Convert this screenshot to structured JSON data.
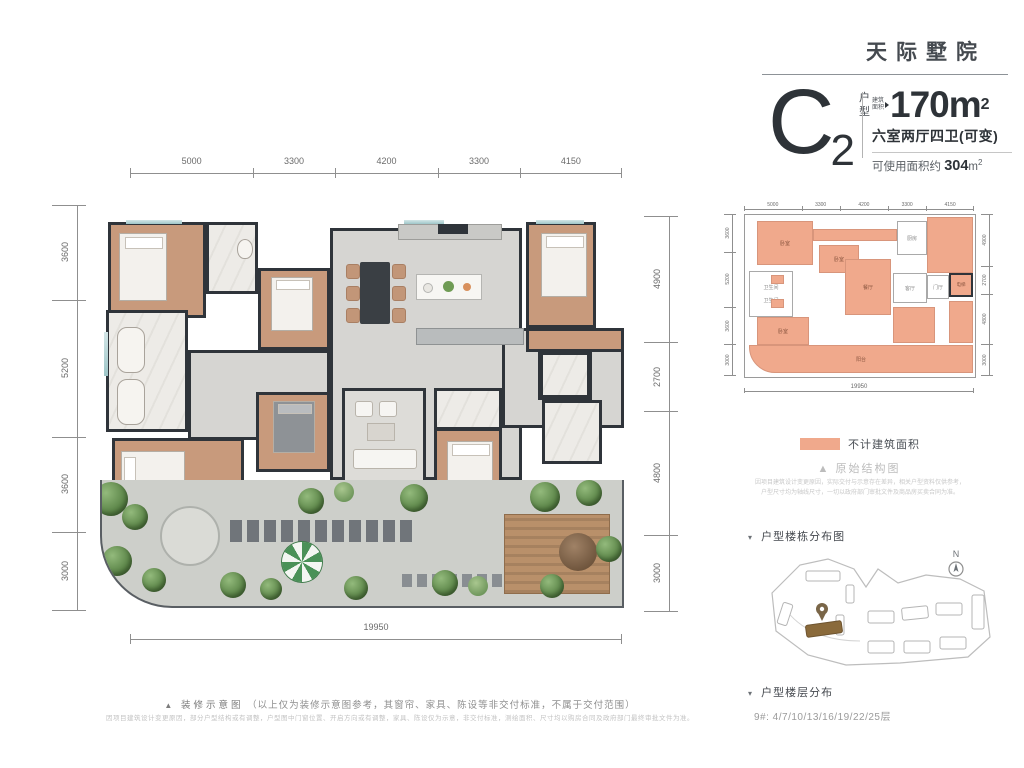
{
  "brand": {
    "title": "天际墅院"
  },
  "unit_card": {
    "type_letter": "C",
    "type_number": "2",
    "type_tag_1": "户",
    "type_tag_2": "型",
    "area_tag_1": "建筑",
    "area_tag_2": "面积",
    "area_main": "170m",
    "area_sup": "2",
    "rooms_line": "六室两厅四卫(可变)",
    "usable_prefix": "可使用面积约 ",
    "usable_value": "304",
    "usable_unit": "m",
    "usable_sup": "2"
  },
  "floor_plan": {
    "dims_top": [
      "5000",
      "3300",
      "4200",
      "3300",
      "4150"
    ],
    "dims_left": [
      "3600",
      "5200",
      "3600",
      "3000"
    ],
    "dims_right": [
      "4900",
      "2700",
      "4800",
      "3000"
    ],
    "dim_bottom": "19950"
  },
  "structure_panel": {
    "legend_label": "不计建筑面积",
    "legend_color": "#f0a98c",
    "marker": "▲",
    "title": "原始结构图",
    "note_line1": "因项目建筑设计变更原因，实际交付与示意存在差异，相关户型资料仅供参考，",
    "note_line2": "户型尺寸均为轴线尺寸，一切以政府部门审批文件及商品房买卖合同为准。",
    "mini_dims_top": [
      "5000",
      "3300",
      "4200",
      "3300",
      "4150"
    ],
    "mini_dims_left": [
      "3600",
      "5200",
      "3600",
      "3000"
    ],
    "mini_dims_right": [
      "4900",
      "2700",
      "4800",
      "3000"
    ],
    "mini_dim_bottom": "19950",
    "rooms": {
      "bed_tl": "卧室",
      "bed_ml": "卧室",
      "bed_bl": "卧室",
      "bath_1": "卫生间",
      "bath_2": "卫生间",
      "dining": "餐厅",
      "kitchen": "厨房",
      "living": "客厅",
      "foyer": "门厅",
      "elevator": "电梯",
      "balcony": "阳台"
    }
  },
  "site_panel": {
    "marker": "▾",
    "title": "户型楼栋分布图",
    "compass": "N"
  },
  "floors_panel": {
    "marker": "▾",
    "title": "户型楼层分布",
    "floors": "9#: 4/7/10/13/16/19/22/25层"
  },
  "footer": {
    "marker": "▲",
    "title": "装修示意图",
    "note": "（以上仅为装修示意图参考，其窗帘、家具、陈设等非交付标准，不属于交付范围）",
    "fine_print": "因项目建筑设计变更原因，部分户型结构或有调整，户型图中门窗位置、开启方向或有调整，家具、陈设仅为示意，非交付标准，测绘面积、尺寸均以购房合同及政府部门最终审批文件为准。"
  },
  "colors": {
    "wall": "#2f343a",
    "wood_floor": "#c89a7c",
    "tile_floor": "#d6d5d2",
    "marble_floor": "#edebe7",
    "greenery": "#557f42",
    "salmon_area": "#f0a98c",
    "highlight_building": "#8a6a3b"
  }
}
